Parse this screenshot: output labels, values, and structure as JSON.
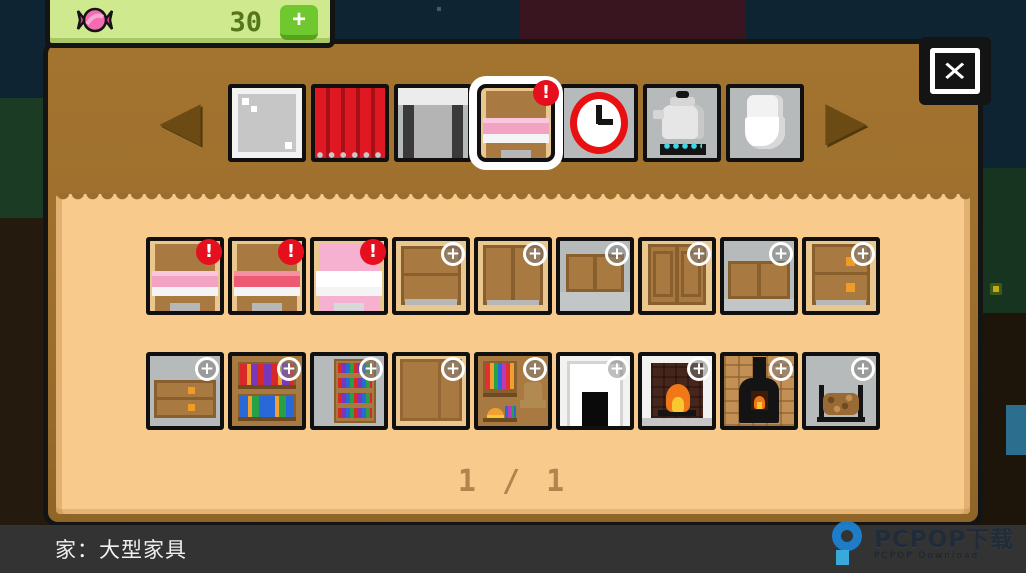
{
  "currency": {
    "icon": "candy-icon",
    "count": "30",
    "add_label": "+"
  },
  "window_controls": {
    "close_label": "✕"
  },
  "category_bar": {
    "prev_label": "◀",
    "next_label": "▶",
    "tabs": [
      {
        "id": "window-glass",
        "badge": "",
        "selected": false
      },
      {
        "id": "curtain",
        "badge": "",
        "selected": false
      },
      {
        "id": "door",
        "badge": "",
        "selected": false
      },
      {
        "id": "bed",
        "badge": "!",
        "selected": true
      },
      {
        "id": "clock",
        "badge": "",
        "selected": false
      },
      {
        "id": "kettle",
        "badge": "",
        "selected": false
      },
      {
        "id": "toilet",
        "badge": "",
        "selected": false
      }
    ]
  },
  "items_grid": {
    "rows": [
      [
        {
          "id": "bed-pink",
          "badge": "!"
        },
        {
          "id": "bed-red",
          "badge": "!"
        },
        {
          "id": "bed-white-pink",
          "badge": "!"
        },
        {
          "id": "dresser",
          "badge": "+"
        },
        {
          "id": "wardrobe-two-door",
          "badge": "+"
        },
        {
          "id": "wall-cabinet",
          "badge": "+"
        },
        {
          "id": "wardrobe-paneled",
          "badge": "+"
        },
        {
          "id": "wall-cabinet-wide",
          "badge": "+"
        },
        {
          "id": "drawer-chest",
          "badge": "+"
        }
      ],
      [
        {
          "id": "low-dresser",
          "badge": "+"
        },
        {
          "id": "bookshelf",
          "badge": "+"
        },
        {
          "id": "tall-bookshelf",
          "badge": "+"
        },
        {
          "id": "plain-wardrobe",
          "badge": "+"
        },
        {
          "id": "open-closet",
          "badge": "+"
        },
        {
          "id": "fireplace-mantel",
          "badge": "+"
        },
        {
          "id": "fireplace-lit",
          "badge": "+"
        },
        {
          "id": "wood-stove",
          "badge": "+"
        },
        {
          "id": "log-rack",
          "badge": "+"
        }
      ]
    ]
  },
  "pager": {
    "label": "1 / 1"
  },
  "footer": {
    "category_label": "家：大型家具"
  },
  "watermark": {
    "brand": "PCPOP下载",
    "subtitle": "PCPOP Download"
  },
  "colors": {
    "panel_brown": "#9c6e2e",
    "panel_tan": "#f8ca8c",
    "currency_bg": "#cfe98f",
    "accent_green": "#6fc82e",
    "badge_red": "#e60f1e",
    "footer_bar": "#333333",
    "watermark_blue": "#1d80d2"
  }
}
